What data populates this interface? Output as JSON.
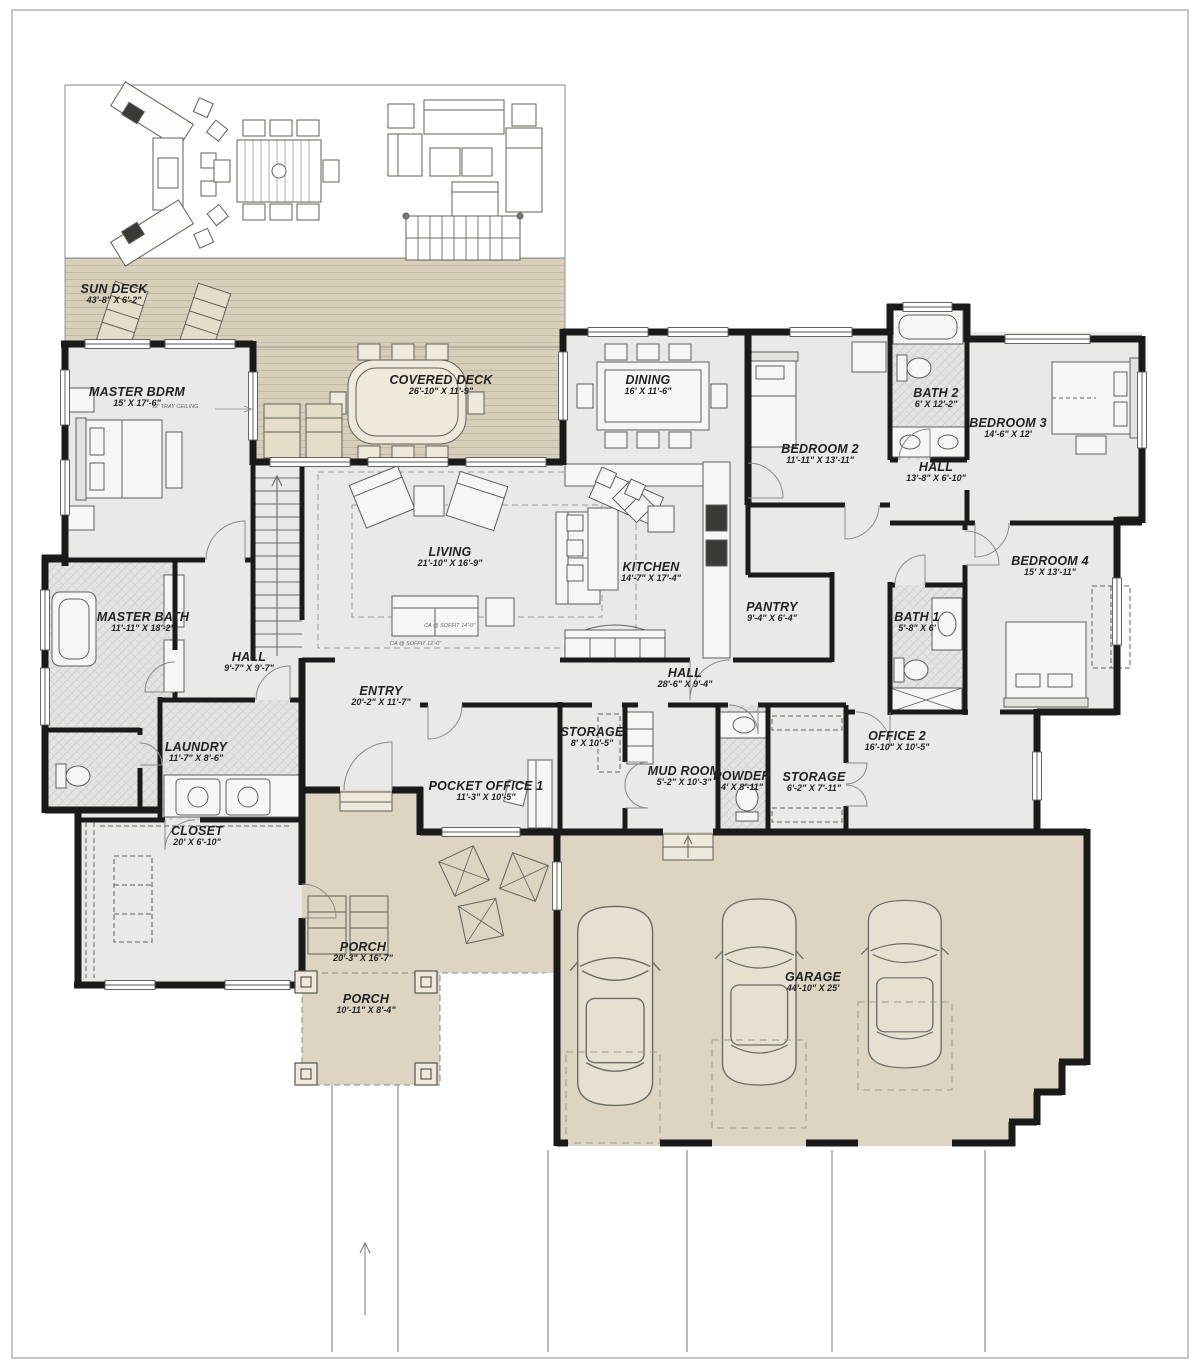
{
  "plan": {
    "type": "floor-plan",
    "colors": {
      "deck": "#d8cfba",
      "porch_garage": "#ddd4c2",
      "interior": "#e9e9e7",
      "wall": "#1a1a1a",
      "thin_line": "#6b6b66"
    },
    "rooms": [
      {
        "id": "sun-deck",
        "name": "SUN DECK",
        "dims": "43'-8\" X 6'-2\""
      },
      {
        "id": "covered-deck",
        "name": "COVERED DECK",
        "dims": "26'-10\" X 11'-9\""
      },
      {
        "id": "master-bdrm",
        "name": "MASTER BDRM",
        "dims": "15' X 17'-6\""
      },
      {
        "id": "dining",
        "name": "DINING",
        "dims": "16' X 11'-6\""
      },
      {
        "id": "bedroom-2",
        "name": "BEDROOM 2",
        "dims": "11'-11\" X 13'-11\""
      },
      {
        "id": "bath-2",
        "name": "BATH 2",
        "dims": "6' X 12'-2\""
      },
      {
        "id": "bedroom-3",
        "name": "BEDROOM 3",
        "dims": "14'-6\" X 12'"
      },
      {
        "id": "hall-right",
        "name": "HALL",
        "dims": "13'-8\" X 6'-10\""
      },
      {
        "id": "bedroom-4",
        "name": "BEDROOM 4",
        "dims": "15' X 13'-11\""
      },
      {
        "id": "bath-1",
        "name": "BATH 1",
        "dims": "5'-8\" X 6'"
      },
      {
        "id": "living",
        "name": "LIVING",
        "dims": "21'-10\" X 16'-9\""
      },
      {
        "id": "kitchen",
        "name": "KITCHEN",
        "dims": "14'-7\" X 17'-4\""
      },
      {
        "id": "pantry",
        "name": "PANTRY",
        "dims": "9'-4\" X 6'-4\""
      },
      {
        "id": "master-bath",
        "name": "MASTER BATH",
        "dims": "11'-11\" X 18'-2\""
      },
      {
        "id": "hall-left",
        "name": "HALL",
        "dims": "9'-7\" X 9'-7\""
      },
      {
        "id": "entry",
        "name": "ENTRY",
        "dims": "20'-2\" X 11'-7\""
      },
      {
        "id": "hall-center",
        "name": "HALL",
        "dims": "28'-6\" X 9'-4\""
      },
      {
        "id": "laundry",
        "name": "LAUNDRY",
        "dims": "11'-7\" X 8'-6\""
      },
      {
        "id": "closet",
        "name": "CLOSET",
        "dims": "20' X 6'-10\""
      },
      {
        "id": "pocket-office-1",
        "name": "POCKET OFFICE 1",
        "dims": "11'-3\" X 10'-5\""
      },
      {
        "id": "storage-center",
        "name": "STORAGE",
        "dims": "8' X 10'-5\""
      },
      {
        "id": "mud-room",
        "name": "MUD ROOM",
        "dims": "5'-2\" X 10'-3\""
      },
      {
        "id": "powder",
        "name": "POWDER",
        "dims": "4' X 8'-11\""
      },
      {
        "id": "storage-right",
        "name": "STORAGE",
        "dims": "6'-2\" X 7'-11\""
      },
      {
        "id": "office-2",
        "name": "OFFICE 2",
        "dims": "16'-10\" X 10'-5\""
      },
      {
        "id": "porch",
        "name": "PORCH",
        "dims": "20'-3\" X 16'-7\""
      },
      {
        "id": "porch-front",
        "name": "PORCH",
        "dims": "10'-11\" X 8'-4\""
      },
      {
        "id": "garage",
        "name": "GARAGE",
        "dims": "44'-10\" X 25'"
      }
    ],
    "annotations": [
      {
        "id": "tray-ceiling",
        "text": "12' TRAY CEILING"
      },
      {
        "id": "soffit-14",
        "text": "CA @ SOFFIT 14'-0\""
      },
      {
        "id": "soffit-12",
        "text": "CA @ SOFFIT 12'-0\""
      }
    ]
  }
}
